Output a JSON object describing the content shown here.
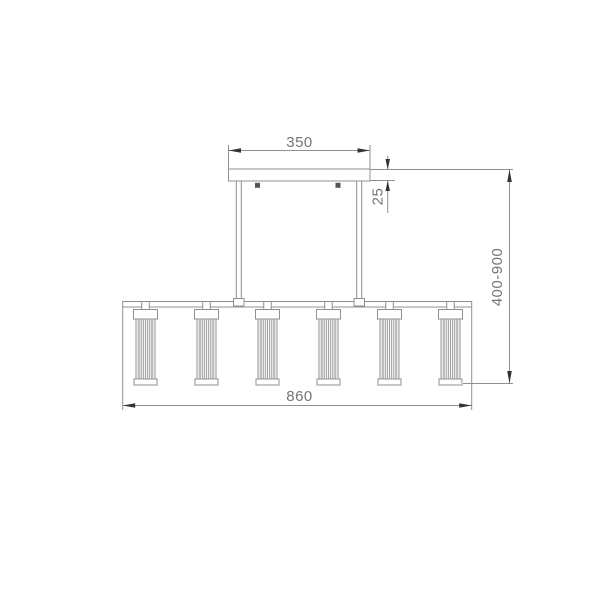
{
  "drawing": {
    "kind": "linear-pendant-light-dimension-drawing",
    "lamp_count": 6
  },
  "labels": {
    "canopy_width": "350",
    "canopy_thickness": "25",
    "suspension_length_range": "400-900",
    "fixture_length": "860"
  },
  "colors": {
    "background": "#ffffff",
    "line": "#909090",
    "arrowhead": "#333333",
    "dimension_text": "#757575",
    "screw": "#555555"
  }
}
